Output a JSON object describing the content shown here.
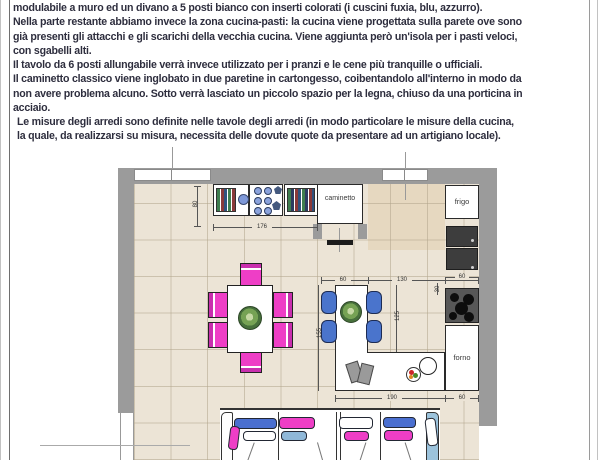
{
  "page": {
    "border_outer_color": "#c2c2c2",
    "border_inner_color": "#6f6f6f"
  },
  "document": {
    "text_color": "#2e2e3e",
    "lines": [
      "modulabile a muro ed un divano a 5 posti bianco con inserti colorati (i cuscini fuxia, blu, azzurro).",
      "Nella parte restante abbiamo invece la zona cucina-pasti: la cucina viene progettata sulla parete ove sono",
      "già presenti gli attacchi e gli scarichi della vecchia cucina. Viene aggiunta però un'isola per i pasti veloci,",
      "con sgabelli alti.",
      "Il tavolo da 6 posti allungabile verrà invece utilizzato per i pranzi e le cene più tranquille o ufficiali.",
      "Il caminetto classico viene inglobato in due paretine in cartongesso, coibentandolo all'interno in modo da",
      "non avere problema alcuno. Sotto verrà lasciato un piccolo spazio per la legna, chiuso da una porticina in",
      "acciaio.",
      "Le misure degli arredi sono definite nelle tavole degli arredi (in modo particolare le misure della cucina,",
      "la quale, da realizzarsi su misura, necessita delle dovute quote da presentare ad un artigiano locale)."
    ]
  },
  "plan": {
    "labels": {
      "fireplace": "caminetto",
      "fridge": "frigo",
      "oven": "forno"
    },
    "dimensions": {
      "shelf_depth": "80",
      "shelf_width": "176",
      "island_top": "60",
      "island_to_wall": "130",
      "cooktop_col": "60",
      "counter_offset": "30",
      "island_inner": "125",
      "island_side": "155",
      "island_bottom": "190",
      "oven_col": "60"
    },
    "colors": {
      "wall": "#9b9b9b",
      "floor": "#ece4d6",
      "floor_line": "#d8cfbd",
      "counter_tint": "#e6d7bd",
      "fuchsia": "#ee3ec6",
      "blue": "#4a74cc",
      "light_blue": "#96bedb",
      "plant_green": "#76a254",
      "appliance_dark": "#3d3d3d",
      "cooktop_gray": "#575757"
    }
  }
}
